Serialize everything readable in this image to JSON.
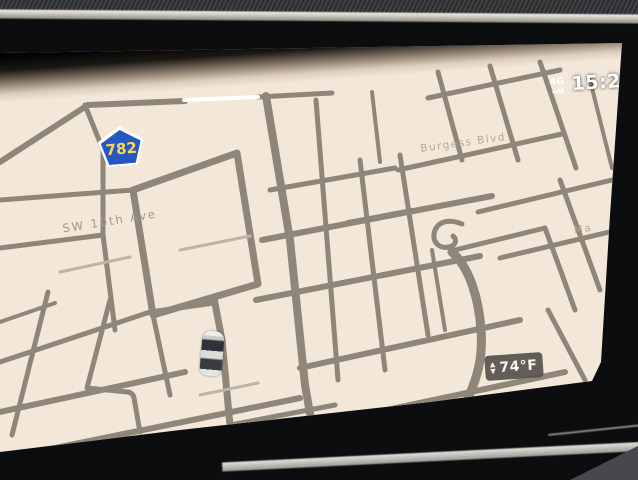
{
  "status_bar": {
    "network": "4G",
    "time": "15:28"
  },
  "map": {
    "route_shield_number": "782",
    "label_sw_10th_ave": "SW 10th Ave",
    "label_burgess_blvd": "Burgess Blvd",
    "label_right_edge_partial": "Ma",
    "background_color": "#f2e7d9",
    "road_color": "#8e8679",
    "shield_blue": "#2757c4",
    "shield_number_color": "#ffd84d"
  },
  "climate_badge": {
    "temperature": "74°F",
    "up_arrow": "▲",
    "down_arrow": "▼"
  }
}
